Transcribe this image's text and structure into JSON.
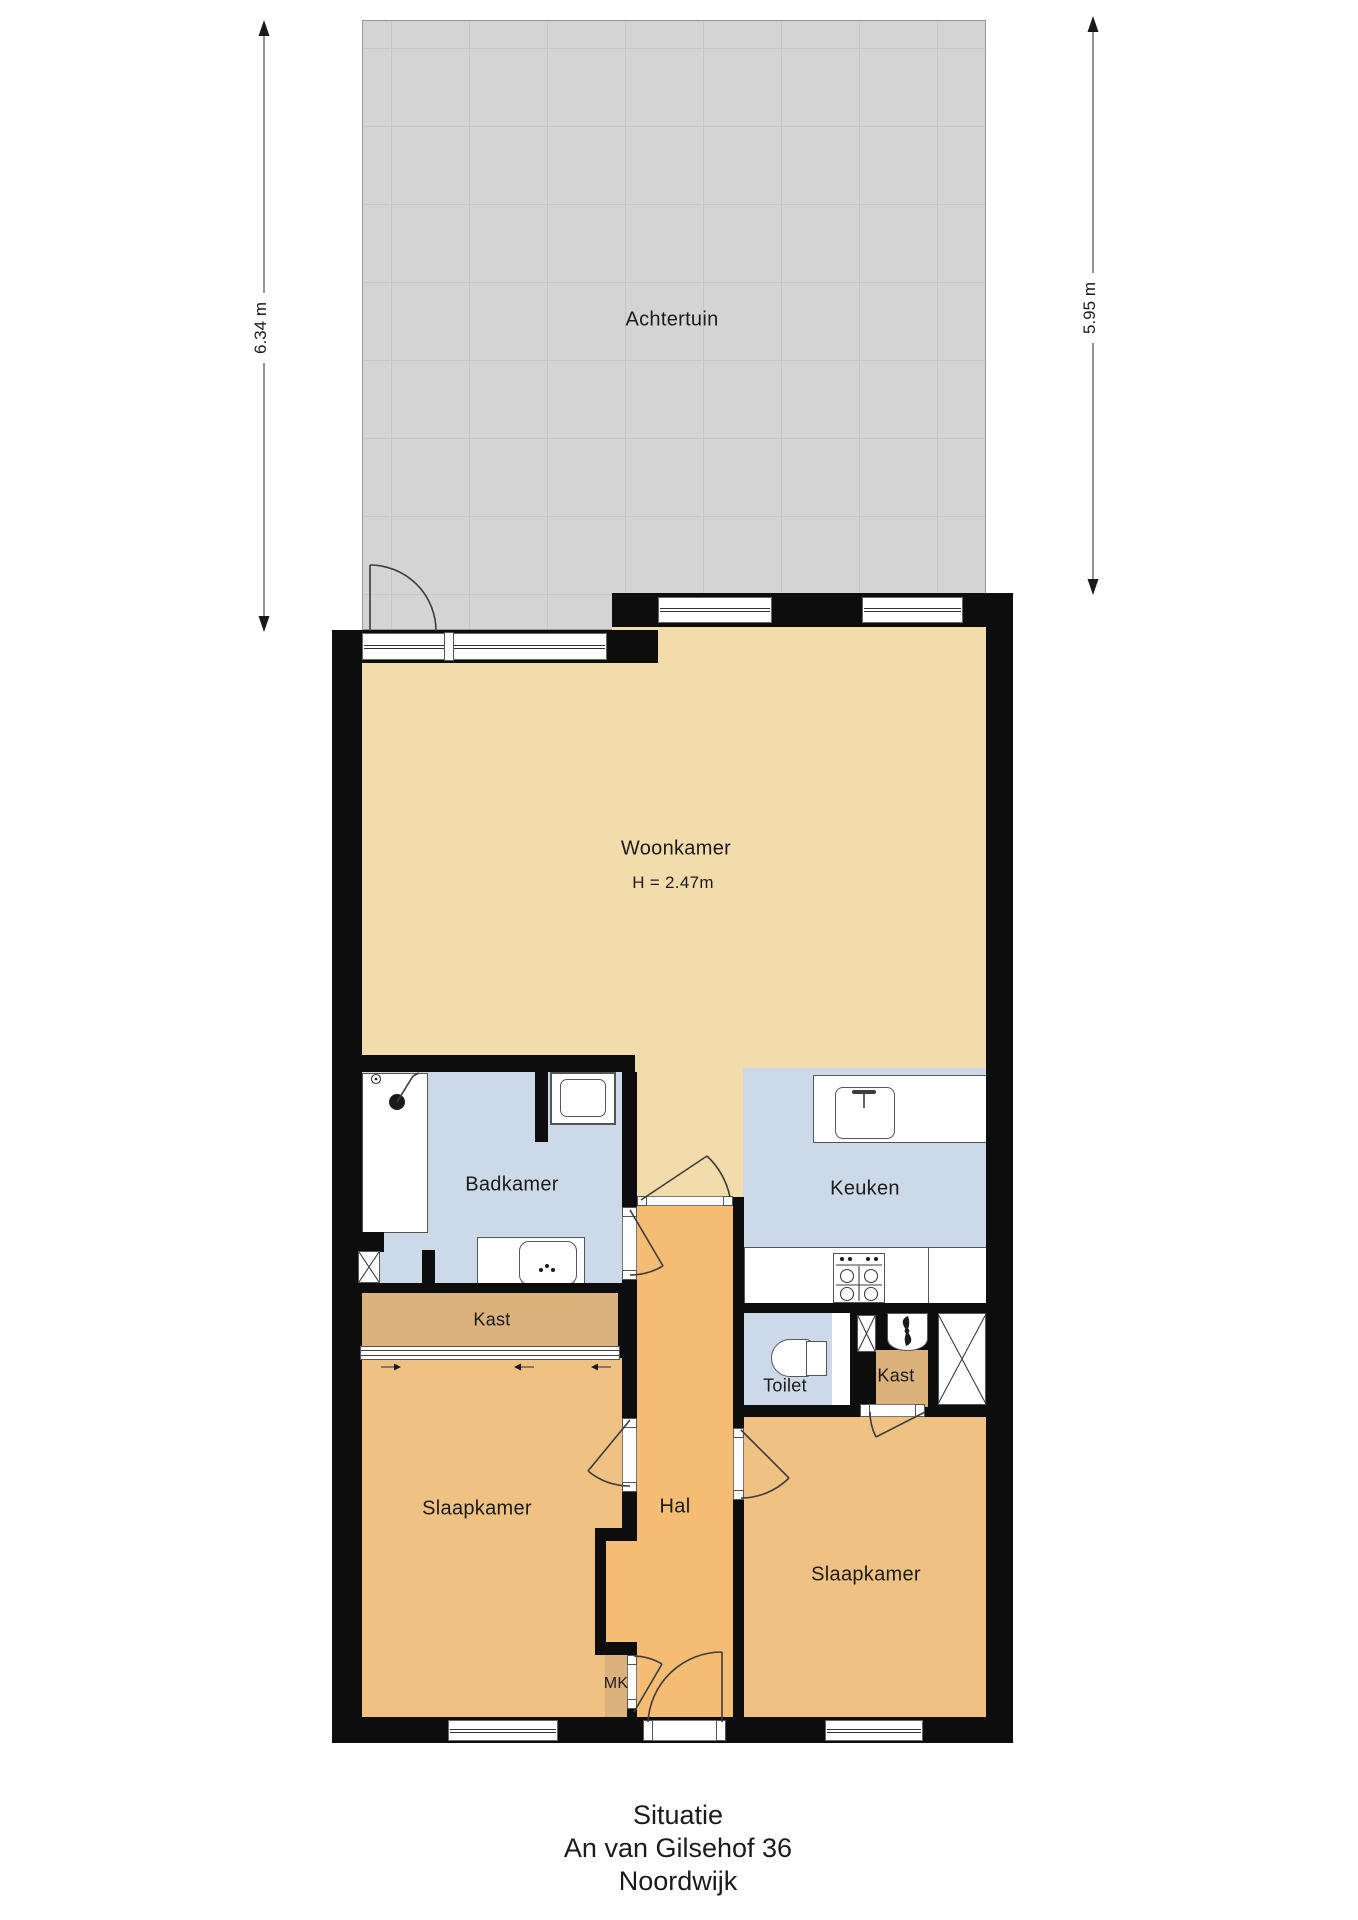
{
  "plan": {
    "type": "floorplan",
    "rooms": {
      "achtertuin": "Achtertuin",
      "woonkamer": "Woonkamer",
      "woonkamer_height": "H = 2.47m",
      "badkamer": "Badkamer",
      "keuken": "Keuken",
      "kast_left": "Kast",
      "kast_right": "Kast",
      "toilet": "Toilet",
      "hal": "Hal",
      "mk": "MK",
      "slaapkamer_left": "Slaapkamer",
      "slaapkamer_right": "Slaapkamer"
    },
    "dimensions": {
      "left": "6.34 m",
      "right": "5.95 m"
    },
    "title": {
      "line1": "Situatie",
      "line2": "An van Gilsehof 36",
      "line3": "Noordwijk"
    }
  },
  "colors": {
    "wall": "#0d0d0d",
    "garden": "#D4D4D4",
    "garden_line": "#C7C7C7",
    "woonkamer": "#F3DCAB",
    "slaapkamer": "#EFC284",
    "hal": "#F5BD73",
    "kast": "#DBB27C",
    "wet": "#CBD9E8"
  }
}
